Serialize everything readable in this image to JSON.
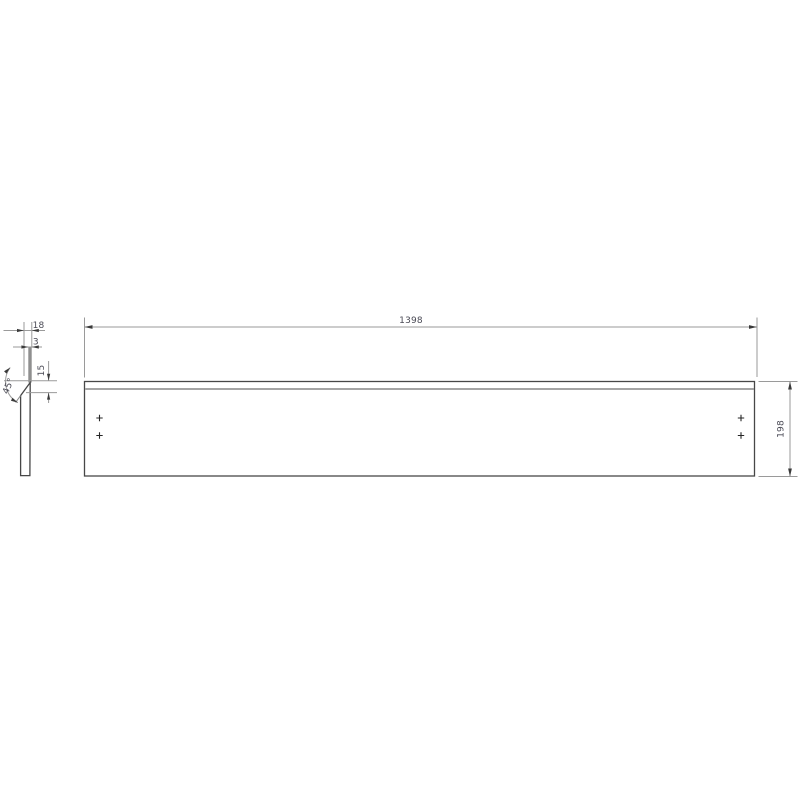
{
  "dimensions": {
    "length": "1398",
    "height": "198",
    "depth": "18",
    "lip_thickness": "3",
    "chamfer_height": "15",
    "chamfer_angle": "45°"
  },
  "colors": {
    "background": "#ffffff",
    "outline": "#474747",
    "dimension_line": "#9a9a9a",
    "arrow": "#3a3a3a",
    "text": "#4a4a55",
    "flange_fill": "#8f8f8f",
    "fold_line": "#979797"
  }
}
